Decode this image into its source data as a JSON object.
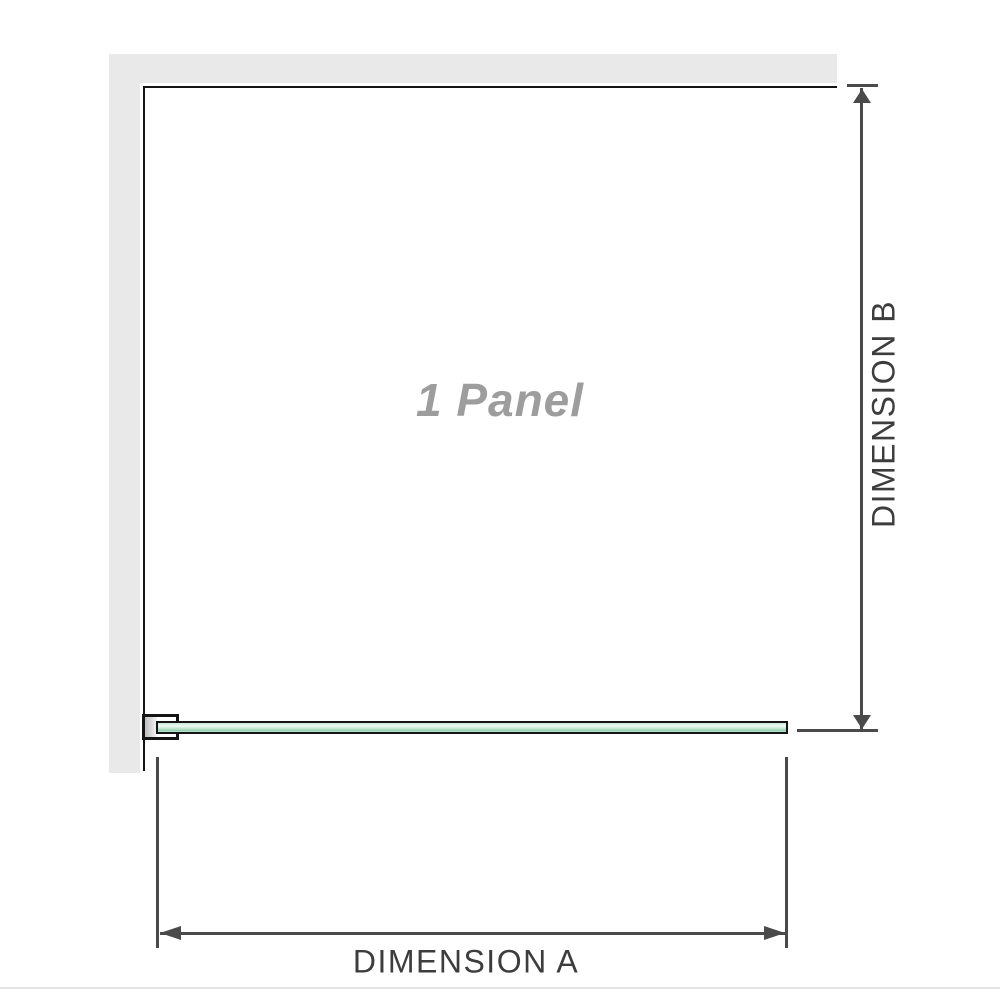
{
  "labels": {
    "panel": "1 Panel",
    "dimension_a": "DIMENSION A",
    "dimension_b": "DIMENSION B"
  },
  "icons": {
    "arrow_up": "dimension-b-arrow-up-icon",
    "arrow_down": "dimension-b-arrow-down-icon",
    "arrow_left": "dimension-a-arrow-left-icon",
    "arrow_right": "dimension-a-arrow-right-icon"
  },
  "colors": {
    "wall": "#e9e9e9",
    "edge": "#141414",
    "dimline": "#4a4a4a",
    "dimtext": "#3d3d3d",
    "paneltext": "#9d9d9d",
    "glasslight": "#eef9f2",
    "glassmid": "#c9e8d6",
    "glassdeep": "#93d1af",
    "blockdark": "#bdbdbd",
    "blocklight": "#f5f5f5",
    "separator": "#e3e3e3"
  }
}
